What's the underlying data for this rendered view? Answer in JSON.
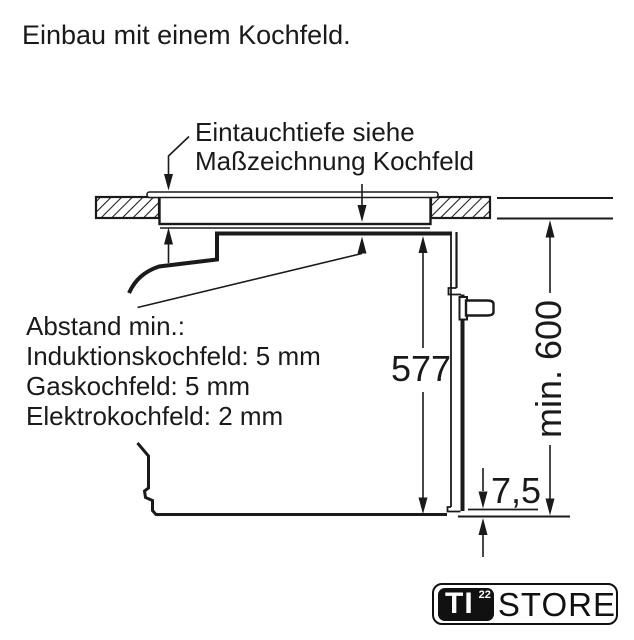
{
  "page": {
    "title": "Einbau mit einem Kochfeld."
  },
  "diagram": {
    "callout": {
      "line1": "Eintauchtiefe siehe",
      "line2": "Maßzeichnung Kochfeld"
    },
    "clearance_note": {
      "heading": "Abstand min.:",
      "items": [
        "Induktionskochfeld: 5 mm",
        "Gaskochfeld: 5 mm",
        "Elektrokochfeld: 2 mm"
      ]
    },
    "dimensions": {
      "oven_height_mm": "577",
      "niche_height": "min. 600",
      "door_bottom_gap_mm": "7,5"
    },
    "colors": {
      "line": "#1a1a1a",
      "background": "#ffffff"
    }
  },
  "watermark": {
    "badge": "TI",
    "badge_sup": "22",
    "text": "STORE"
  }
}
